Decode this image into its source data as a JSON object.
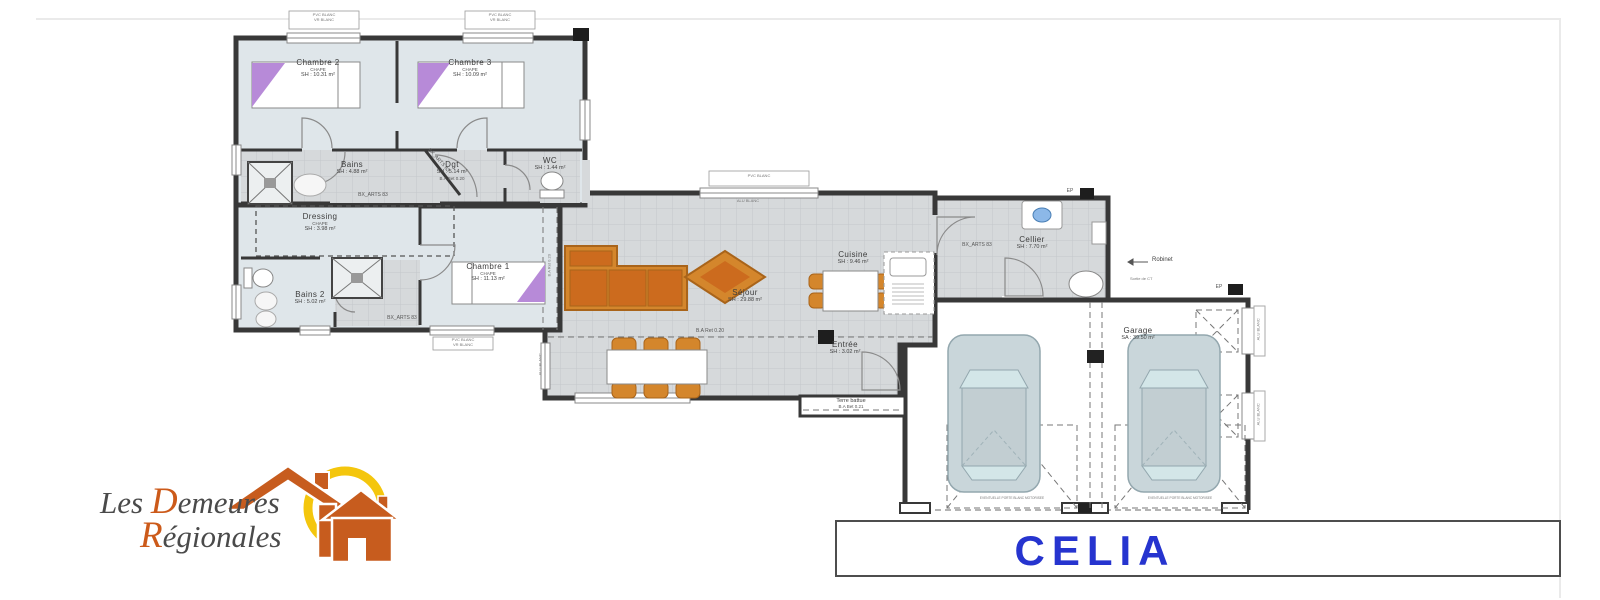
{
  "plan": {
    "rooms": {
      "chambre2": {
        "name": "Chambre 2",
        "sub": "CHAPE",
        "area": "SH : 10.31 m²"
      },
      "chambre3": {
        "name": "Chambre 3",
        "sub": "CHAPE",
        "area": "SH : 10.09 m²"
      },
      "bains": {
        "name": "Bains",
        "area": "SH : 4.88 m²"
      },
      "dgt": {
        "name": "Dgt",
        "area": "SH : 5.14 m²",
        "note": "B.A Bet 0.20"
      },
      "wc": {
        "name": "WC",
        "area": "SH : 1.44 m²"
      },
      "dressing": {
        "name": "Dressing",
        "sub": "CHAPE",
        "area": "SH : 3.98 m²"
      },
      "bains2": {
        "name": "Bains 2",
        "area": "SH : 5.02 m²"
      },
      "chambre1": {
        "name": "Chambre 1",
        "sub": "CHAPE",
        "area": "SH : 11.13 m²"
      },
      "sejour": {
        "name": "Séjour",
        "area": "SH : 29.88 m²"
      },
      "cuisine": {
        "name": "Cuisine",
        "area": "SH : 9.46 m²"
      },
      "entree": {
        "name": "Entrée",
        "area": "SH : 3.02 m²"
      },
      "cellier": {
        "name": "Cellier",
        "area": "SH : 7.70 m²"
      },
      "garage": {
        "name": "Garage",
        "area": "SA : 39.50 m²"
      },
      "terre_battue": {
        "name": "Terre battue",
        "note": "B.A Bet 0.21"
      }
    },
    "annotations": {
      "bx_arts": "BX_ARTS 83",
      "ba_ret": "B.A Ret 0.20",
      "robinet": "Robinet",
      "sortie": "Sortie de CT",
      "ep": "EP",
      "window_line1": "PVC BLANC",
      "window_line2": "VR BLANC",
      "alu_blanc": "ALU BLANC",
      "garage_door_note": "EVENTUELLE PORTE BLANC MOTORISEE"
    }
  },
  "logo": {
    "line1_prefix": "Les ",
    "line1_cap": "D",
    "line1_rest": "emeures",
    "line2_cap": "R",
    "line2_rest": "égionales"
  },
  "title_block": {
    "name": "CELIA"
  },
  "colors": {
    "wall": "#383838",
    "tile_floor": "#d6d9db",
    "room_floor": "#dfe6ea",
    "furniture_orange": "#d4862c",
    "furniture_orange_dark": "#cc6b1e",
    "bed_purple": "#b78ad8",
    "car_body": "#c9d6da",
    "title_blue": "#2634cf",
    "logo_orange": "#c75c1e",
    "logo_sun_yellow": "#f4c60d"
  }
}
